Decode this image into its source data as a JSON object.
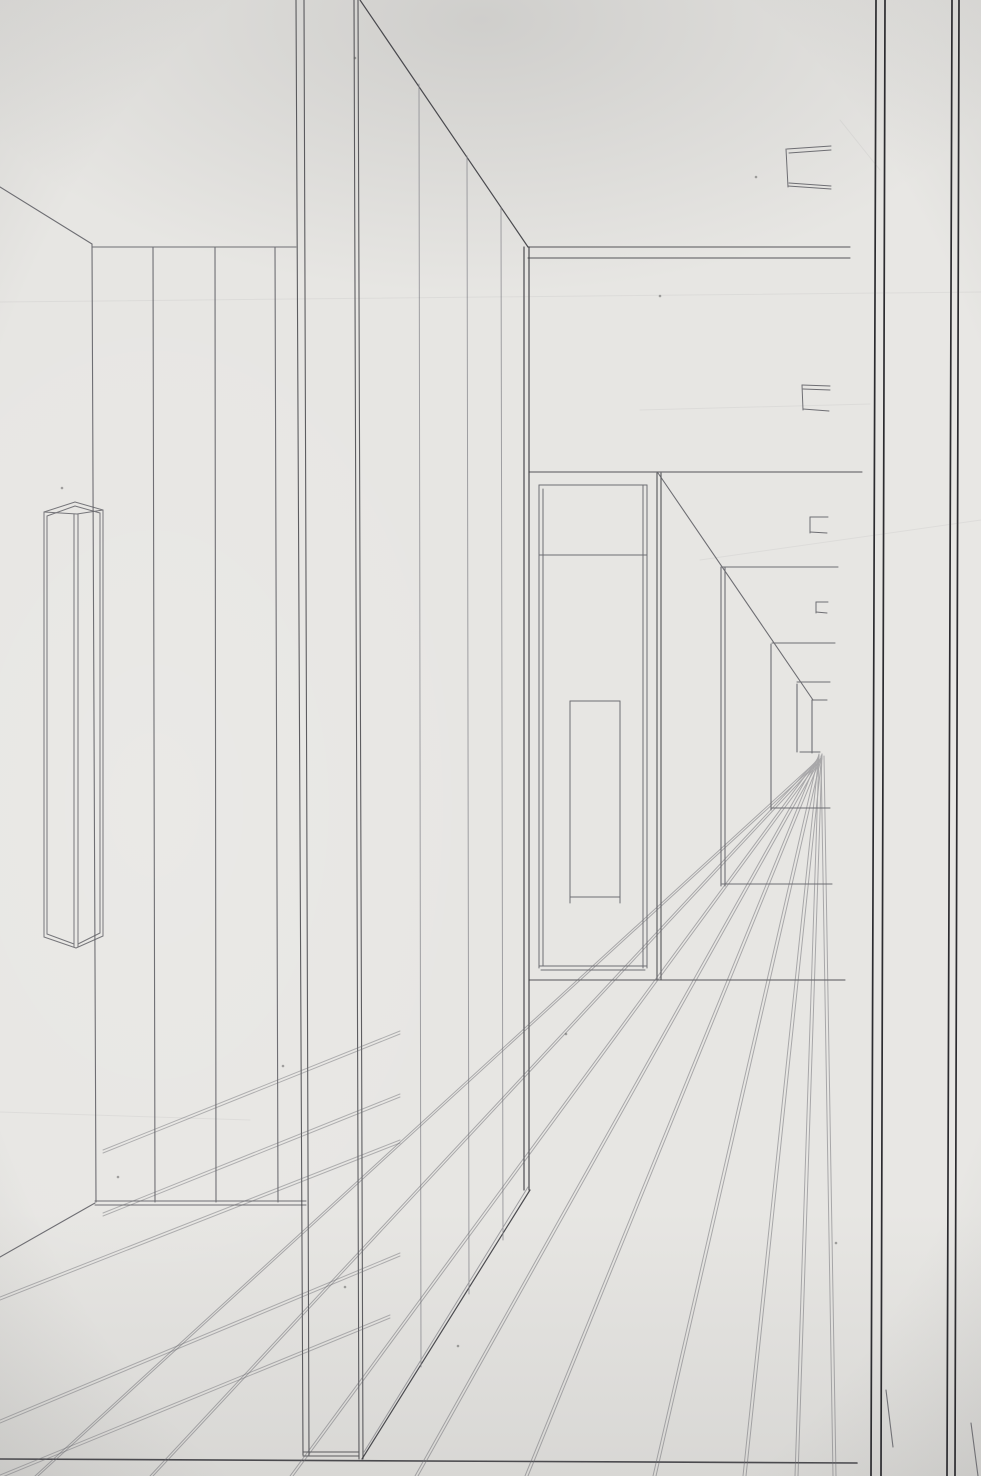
{
  "meta": {
    "title": "One-point perspective corridor drawing",
    "medium": "pencil line drawing on paper, photographed",
    "visible_text": ""
  },
  "palette": {
    "paper": "#e7e6e3",
    "line_dark": "#3b3b40",
    "line_frame": "#232327",
    "line_mid": "#5a5a60",
    "line_faint": "#86868c",
    "line_floor": "#6a6a70",
    "speck": "#555555"
  },
  "canvas": {
    "width": 981,
    "height": 1476
  },
  "vanishing_points": {
    "vp1": [
      820,
      753
    ],
    "vp2": [
      1100,
      753
    ]
  },
  "drawing": {
    "groups": [
      {
        "name": "left-wall",
        "stroke": "line_mid",
        "width": 1.1,
        "opacity": 0.85,
        "segments": [
          [
            0,
            187,
            92,
            244
          ],
          [
            92,
            244,
            96,
            1202
          ],
          [
            153,
            247,
            155,
            1202
          ],
          [
            215,
            247,
            216,
            1202
          ],
          [
            275,
            247,
            278,
            1202
          ],
          [
            92,
            247,
            296,
            247
          ],
          [
            95,
            1201,
            306,
            1201
          ],
          [
            95,
            1205,
            306,
            1205
          ],
          [
            95,
            1203,
            0,
            1257
          ]
        ]
      },
      {
        "name": "column-box",
        "stroke": "line_mid",
        "width": 1.0,
        "opacity": 0.8,
        "segments": [
          [
            44,
            512,
            75,
            502
          ],
          [
            75,
            502,
            103,
            510
          ],
          [
            44,
            512,
            77,
            514
          ],
          [
            77,
            514,
            103,
            510
          ],
          [
            47,
            516,
            75,
            506
          ],
          [
            75,
            506,
            100,
            513
          ],
          [
            44,
            512,
            44,
            937
          ],
          [
            47,
            516,
            47,
            934
          ],
          [
            103,
            510,
            103,
            936
          ],
          [
            100,
            513,
            100,
            933
          ],
          [
            74,
            514,
            74,
            947
          ],
          [
            78,
            514,
            78,
            947
          ],
          [
            44,
            937,
            76,
            948
          ],
          [
            103,
            936,
            76,
            948
          ],
          [
            47,
            934,
            74,
            944
          ],
          [
            100,
            933,
            78,
            944
          ]
        ]
      },
      {
        "name": "slab-front-face",
        "stroke": "line_dark",
        "width": 1.1,
        "opacity": 0.8,
        "segments": [
          [
            296,
            0,
            303,
            1455
          ],
          [
            304,
            0,
            309,
            1455
          ],
          [
            354,
            0,
            359,
            1459
          ],
          [
            358,
            0,
            363,
            1459
          ],
          [
            303,
            1452,
            359,
            1452
          ],
          [
            303,
            1456,
            359,
            1456
          ]
        ]
      },
      {
        "name": "slab-side-face",
        "stroke": "line_dark",
        "width": 1.2,
        "opacity": 0.9,
        "segments": [
          [
            360,
            0,
            528,
            247
          ],
          [
            524,
            247,
            524,
            1190
          ],
          [
            529,
            247,
            529,
            1190
          ],
          [
            362,
            1459,
            530,
            1190
          ]
        ]
      },
      {
        "name": "slab-side-panel-lines",
        "stroke": "line_faint",
        "width": 1.0,
        "opacity": 0.75,
        "segments": [
          [
            364,
            1452,
            528,
            1187
          ],
          [
            419,
            84,
            421,
            1367
          ],
          [
            467,
            156,
            469,
            1294
          ],
          [
            501,
            208,
            503,
            1240
          ]
        ]
      },
      {
        "name": "far-wall",
        "stroke": "line_dark",
        "width": 1.1,
        "opacity": 0.85,
        "segments": [
          [
            528,
            247,
            850,
            247
          ],
          [
            528,
            258,
            850,
            258
          ],
          [
            529,
            472,
            862,
            472
          ],
          [
            529,
            980,
            845,
            980
          ],
          [
            657,
            473,
            657,
            980
          ],
          [
            661,
            473,
            661,
            980
          ]
        ]
      },
      {
        "name": "door-frame",
        "stroke": "line_mid",
        "width": 1.0,
        "opacity": 0.85,
        "segments": [
          [
            539,
            485,
            647,
            485
          ],
          [
            539,
            485,
            539,
            968
          ],
          [
            543,
            489,
            543,
            966
          ],
          [
            643,
            485,
            643,
            968
          ],
          [
            647,
            485,
            647,
            968
          ],
          [
            539,
            555,
            647,
            555
          ],
          [
            539,
            966,
            647,
            966
          ],
          [
            541,
            970,
            645,
            970
          ],
          [
            570,
            701,
            620,
            701
          ],
          [
            570,
            701,
            570,
            897
          ],
          [
            620,
            701,
            620,
            897
          ],
          [
            570,
            897,
            620,
            897
          ],
          [
            570,
            897,
            570,
            903
          ],
          [
            620,
            897,
            620,
            903
          ]
        ]
      },
      {
        "name": "right-corridor-wall",
        "stroke": "line_mid",
        "width": 1.1,
        "opacity": 0.85,
        "segments": [
          [
            658,
            473,
            813,
            700
          ],
          [
            721,
            567,
            721,
            886
          ],
          [
            725,
            567,
            725,
            886
          ],
          [
            722,
            567,
            838,
            567
          ],
          [
            722,
            884,
            832,
            884
          ],
          [
            771,
            644,
            771,
            810
          ],
          [
            772,
            643,
            835,
            643
          ],
          [
            772,
            808,
            830,
            808
          ],
          [
            797,
            682,
            830,
            682
          ],
          [
            797,
            684,
            797,
            752
          ],
          [
            812,
            700,
            827,
            700
          ],
          [
            812,
            700,
            812,
            753
          ],
          [
            800,
            752,
            820,
            752
          ]
        ]
      },
      {
        "name": "ceiling-brackets",
        "stroke": "line_mid",
        "width": 1.0,
        "opacity": 0.85,
        "segments": [
          [
            787,
            149,
            831,
            146
          ],
          [
            789,
            153,
            831,
            150
          ],
          [
            786,
            149,
            788,
            187
          ],
          [
            788,
            186,
            831,
            189
          ],
          [
            789,
            183,
            831,
            186
          ],
          [
            802,
            385,
            830,
            386
          ],
          [
            803,
            389,
            830,
            390
          ],
          [
            802,
            385,
            803,
            410
          ],
          [
            803,
            409,
            829,
            411
          ],
          [
            810,
            517,
            828,
            517
          ],
          [
            810,
            517,
            810,
            533
          ],
          [
            810,
            532,
            827,
            533
          ],
          [
            816,
            602,
            828,
            602
          ],
          [
            816,
            602,
            816,
            613
          ],
          [
            816,
            612,
            827,
            613
          ]
        ]
      },
      {
        "name": "right-frame-pillar",
        "stroke": "line_frame",
        "width": 1.7,
        "opacity": 0.95,
        "segments": [
          [
            876,
            0,
            871,
            1476
          ],
          [
            885,
            0,
            881,
            1476
          ],
          [
            952,
            0,
            947,
            1476
          ],
          [
            959,
            0,
            955,
            1476
          ]
        ]
      },
      {
        "name": "right-frame-floor-stubs",
        "stroke": "line_mid",
        "width": 1.1,
        "opacity": 0.8,
        "segments": [
          [
            886,
            1390,
            893,
            1447
          ],
          [
            971,
            1423,
            978,
            1476
          ]
        ]
      },
      {
        "name": "baseline",
        "stroke": "line_dark",
        "width": 1.6,
        "opacity": 0.9,
        "segments": [
          [
            0,
            1459,
            857,
            1463
          ]
        ]
      },
      {
        "name": "floor-fan-lines",
        "stroke": "line_floor",
        "width": 1.0,
        "opacity": 0.5,
        "twin": [
          3,
          0
        ],
        "segments": [
          [
            821,
            756,
            833,
            1476
          ],
          [
            819,
            754,
            795,
            1476
          ],
          [
            819,
            754,
            743,
            1476
          ],
          [
            819,
            754,
            653,
            1476
          ],
          [
            819,
            755,
            525,
            1476
          ],
          [
            819,
            756,
            415,
            1476
          ],
          [
            819,
            757,
            290,
            1476
          ],
          [
            819,
            758,
            150,
            1476
          ],
          [
            819,
            759,
            35,
            1476
          ]
        ]
      },
      {
        "name": "floor-left-lines",
        "stroke": "line_floor",
        "width": 1.0,
        "opacity": 0.45,
        "twin": [
          0,
          3
        ],
        "segments": [
          [
            103,
            1150,
            400,
            1031
          ],
          [
            103,
            1213,
            400,
            1094
          ],
          [
            0,
            1297,
            400,
            1140
          ],
          [
            0,
            1420,
            400,
            1253
          ],
          [
            0,
            1475,
            390,
            1315
          ]
        ]
      },
      {
        "name": "paper-creases",
        "stroke": "line_mid",
        "width": 1.0,
        "opacity": 0.07,
        "segments": [
          [
            0,
            302,
            981,
            292
          ],
          [
            640,
            410,
            870,
            404
          ],
          [
            0,
            1112,
            250,
            1120
          ],
          [
            700,
            560,
            981,
            520
          ],
          [
            840,
            120,
            880,
            170
          ]
        ]
      }
    ],
    "specks": [
      [
        62,
        488
      ],
      [
        355,
        58
      ],
      [
        345,
        1287
      ],
      [
        458,
        1346
      ],
      [
        660,
        296
      ],
      [
        756,
        177
      ],
      [
        566,
        1034
      ],
      [
        836,
        1243
      ],
      [
        118,
        1177
      ],
      [
        283,
        1066
      ]
    ]
  }
}
